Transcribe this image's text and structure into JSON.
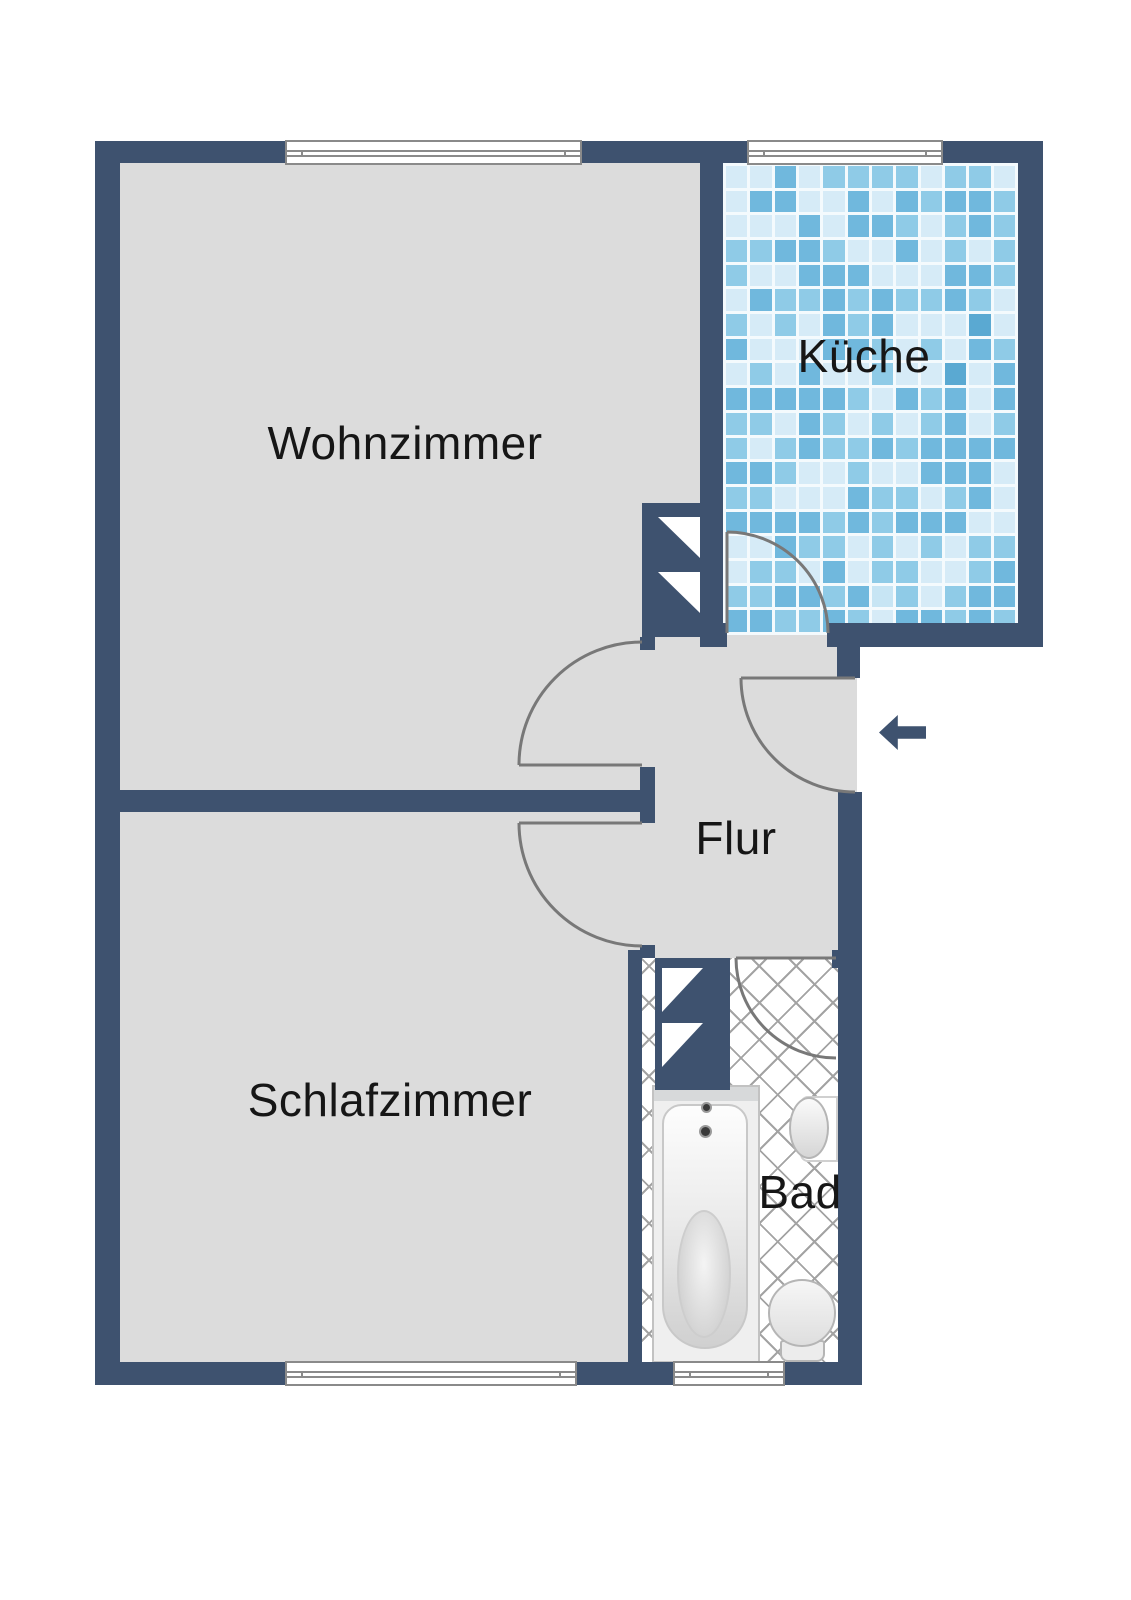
{
  "floorplan": {
    "rooms": {
      "wohnzimmer": {
        "label": "Wohnzimmer"
      },
      "kueche": {
        "label": "Küche"
      },
      "flur": {
        "label": "Flur"
      },
      "schlafzimmer": {
        "label": "Schlafzimmer"
      },
      "bad": {
        "label": "Bad"
      }
    },
    "entrance": {
      "icon": "arrow-left-icon",
      "meaning": "entrance direction"
    },
    "colors": {
      "wall": "#3e526f",
      "floor": "#dcdcdc",
      "hatch": "#a3a3a3",
      "arc": "#787878",
      "winborder": "#8a8a8a",
      "label": "#161616",
      "fixborder": "#b5b5b5",
      "grout": "#f4fafd"
    },
    "kitchen_tile_palette": [
      "#d6ebf7",
      "#aedaef",
      "#8fcbe7",
      "#c7e5f4",
      "#70b8dd",
      "#5aa9d2",
      "#e2f2fa",
      "#aedaef",
      "#8fcbe7",
      "#c7e5f4",
      "#9ed3ec",
      "#bfe1f2"
    ]
  }
}
